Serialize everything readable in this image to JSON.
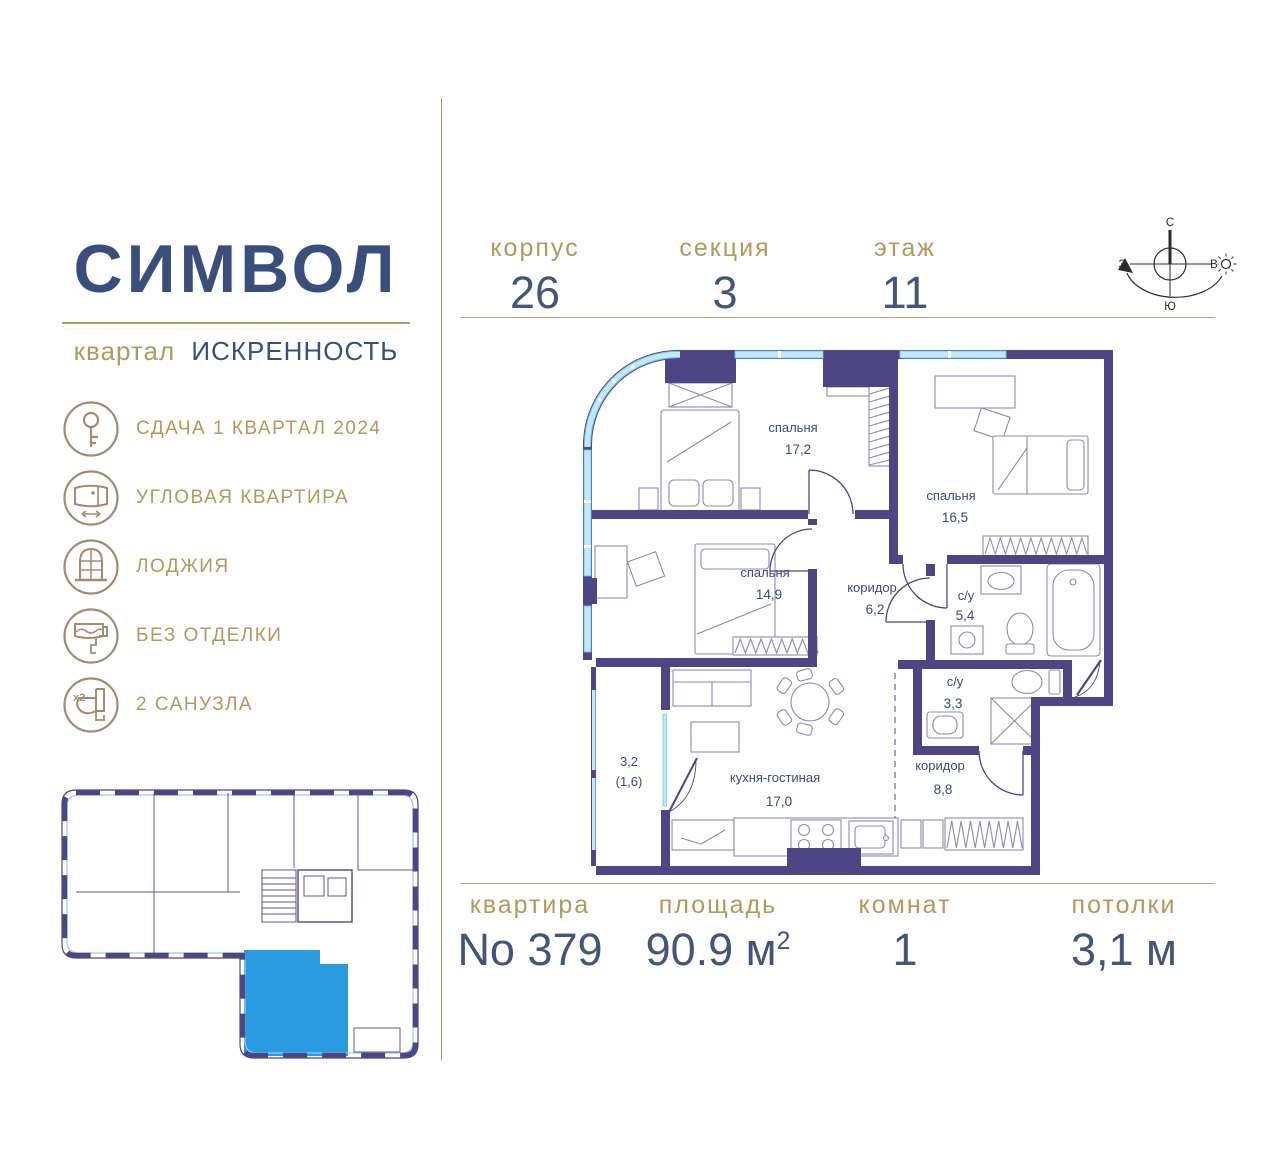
{
  "brand": {
    "name": "СИМВОЛ",
    "district_label": "квартал",
    "district": "ИСКРЕННОСТЬ"
  },
  "header": {
    "items": [
      {
        "label": "корпус",
        "value": "26"
      },
      {
        "label": "секция",
        "value": "3"
      },
      {
        "label": "этаж",
        "value": "11"
      }
    ],
    "compass": {
      "north": "С",
      "south": "Ю",
      "west": "З",
      "east": "В"
    }
  },
  "features": [
    {
      "icon": "key-icon",
      "label": "СДАЧА 1 КВАРТАЛ 2024"
    },
    {
      "icon": "corner-apartment-icon",
      "label": "УГЛОВАЯ КВАРТИРА"
    },
    {
      "icon": "arched-window-icon",
      "label": "ЛОДЖИЯ"
    },
    {
      "icon": "paint-roller-icon",
      "label": "БЕЗ ОТДЕЛКИ"
    },
    {
      "icon": "toilet-x2-icon",
      "label": "2 САНУЗЛА",
      "badge": "x2"
    }
  ],
  "plan": {
    "rooms": [
      {
        "name": "спальня",
        "area": "17,2"
      },
      {
        "name": "спальня",
        "area": "16,5"
      },
      {
        "name": "спальня",
        "area": "14,9"
      },
      {
        "name": "коридор",
        "area": "6,2"
      },
      {
        "name": "с/у",
        "area": "5,4"
      },
      {
        "name": "с/у",
        "area": "3,3"
      },
      {
        "name": "кухня-гостиная",
        "area": "17,0"
      },
      {
        "name": "коридор",
        "area": "8,8"
      },
      {
        "name": "3,2",
        "area": "(1,6)"
      }
    ]
  },
  "footer": {
    "items": [
      {
        "label": "квартира",
        "value": "No 379",
        "sup": ""
      },
      {
        "label": "площадь",
        "value": "90.9 м",
        "sup": "2"
      },
      {
        "label": "комнат",
        "value": "1",
        "sup": ""
      },
      {
        "label": "потолки",
        "value": "3,1 м",
        "sup": ""
      }
    ]
  },
  "colors": {
    "accent_gold": "#b4985c",
    "brand_blue": "#3a4e7c",
    "wall_purple": "#4e4585",
    "window_blue": "#c3e9f8",
    "highlight_blue": "#2a9be0"
  }
}
